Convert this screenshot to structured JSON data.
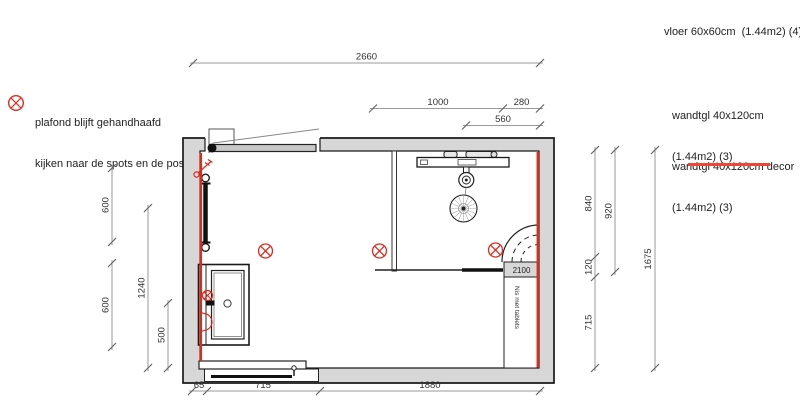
{
  "note": {
    "line1": "plafond blijft gehandhaafd",
    "line2": "kijken naar de spots en de positie"
  },
  "legend": {
    "floor": "vloer 60x60cm  (1.44m2) (4)",
    "wall_tile": {
      "line1": "wandtgl 40x120cm",
      "line2": "(1.44m2) (3)"
    },
    "wall_tile_decor": {
      "line1": "wandtgl 40x120cm decor",
      "line2": "(1.44m2) (3)"
    }
  },
  "plan": {
    "niche_label": "Nis met tablets",
    "niche_height": "2100",
    "dimensions": {
      "top": [
        "2660",
        "1000",
        "280",
        "560"
      ],
      "left": [
        "600",
        "600",
        "1240",
        "500"
      ],
      "right": [
        "840",
        "920",
        "120",
        "715",
        "1675"
      ],
      "bottom": [
        "65",
        "715",
        "1880"
      ]
    }
  },
  "icons": {
    "spot_light": "circled-x-icon",
    "note_marker": "circled-x-icon"
  },
  "colors": {
    "accent_red": "#dd2b1c",
    "underline_red": "#ef4436",
    "wall_fill": "#d7d7d7",
    "outline": "#1a1a1a",
    "dim_line": "#999999"
  }
}
